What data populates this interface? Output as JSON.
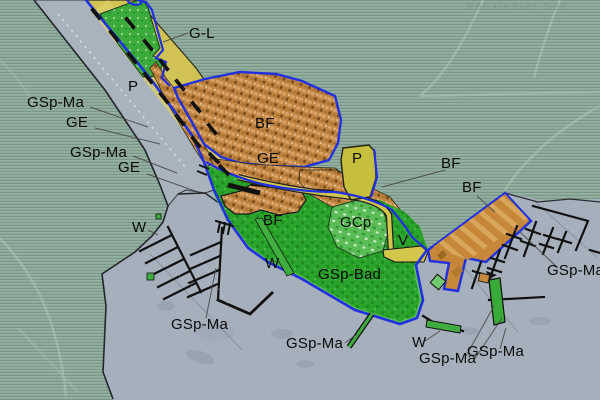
{
  "map": {
    "lake_label": "Neusiedler  See",
    "zone_codes": [
      "GSp-Ma",
      "GE",
      "BF",
      "G-L",
      "P",
      "GCp",
      "GSp-Bad",
      "V",
      "W"
    ],
    "colors": {
      "land": "#8fab9d",
      "water": "#a6b0bd",
      "marina_strip": "#a9b3be",
      "road": "#d0c254",
      "building_zone": "#c08540",
      "green_zone": "#2aa42a",
      "camping_zone": "#5cbd58",
      "parking_zone": "#c6bf3e",
      "plan_boundary": "#2130e0",
      "pier": "#111111"
    }
  },
  "labels": [
    {
      "id": "g-l",
      "text": "G-L"
    },
    {
      "id": "p-road",
      "text": "P"
    },
    {
      "id": "gsp-ma-1",
      "text": "GSp-Ma"
    },
    {
      "id": "ge-1",
      "text": "GE"
    },
    {
      "id": "gsp-ma-2",
      "text": "GSp-Ma"
    },
    {
      "id": "ge-2",
      "text": "GE"
    },
    {
      "id": "bf-main",
      "text": "BF"
    },
    {
      "id": "ge-3",
      "text": "GE"
    },
    {
      "id": "p-zone",
      "text": "P"
    },
    {
      "id": "bf-right-1",
      "text": "BF"
    },
    {
      "id": "bf-right-2",
      "text": "BF"
    },
    {
      "id": "bf-center",
      "text": "BF"
    },
    {
      "id": "gcp",
      "text": "GCp"
    },
    {
      "id": "v",
      "text": "V"
    },
    {
      "id": "gsp-bad",
      "text": "GSp-Bad"
    },
    {
      "id": "w-1",
      "text": "W"
    },
    {
      "id": "w-2",
      "text": "W"
    },
    {
      "id": "gsp-ma-3",
      "text": "GSp-Ma"
    },
    {
      "id": "gsp-ma-4",
      "text": "GSp-Ma"
    },
    {
      "id": "w-3",
      "text": "W"
    },
    {
      "id": "gsp-ma-5",
      "text": "GSp-Ma"
    },
    {
      "id": "gsp-ma-6",
      "text": "GSp-Ma"
    },
    {
      "id": "gsp-ma-7",
      "text": "GSp-Ma"
    }
  ]
}
